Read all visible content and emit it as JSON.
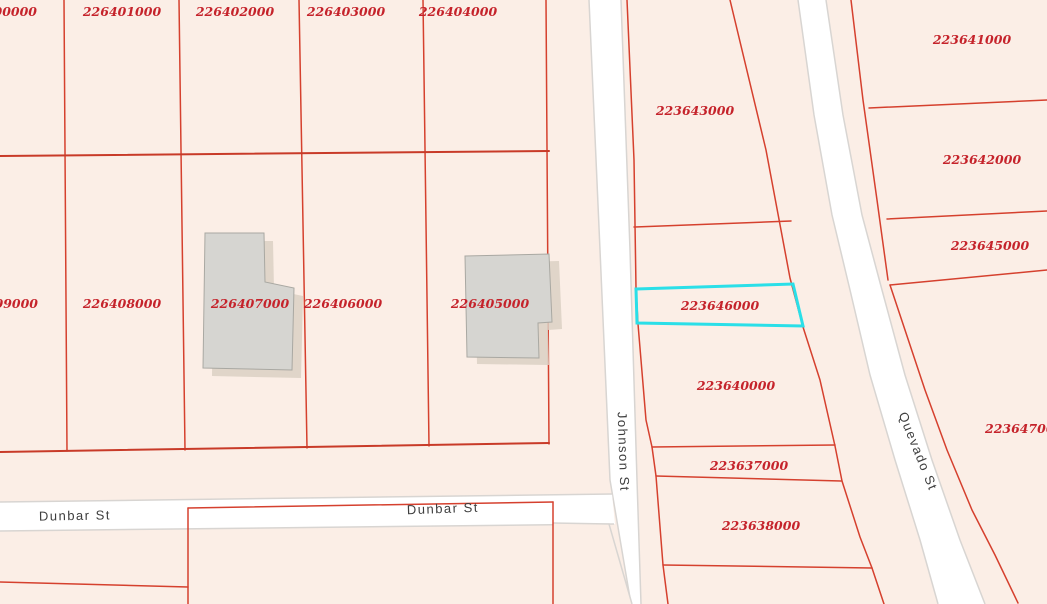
{
  "map_type": "cadastral-parcel-map",
  "highlighted_parcel": "223646000",
  "parcels": [
    {
      "id": "226400000",
      "note": "clipped-left-edge"
    },
    {
      "id": "226401000"
    },
    {
      "id": "226402000"
    },
    {
      "id": "226403000"
    },
    {
      "id": "226404000"
    },
    {
      "id": "226409000",
      "note": "clipped-left-edge"
    },
    {
      "id": "226408000"
    },
    {
      "id": "226407000",
      "has_building": true
    },
    {
      "id": "226406000"
    },
    {
      "id": "226405000",
      "has_building": true
    },
    {
      "id": "223643000"
    },
    {
      "id": "223641000"
    },
    {
      "id": "223642000"
    },
    {
      "id": "223645000"
    },
    {
      "id": "223646000",
      "highlighted": true
    },
    {
      "id": "223640000"
    },
    {
      "id": "223637000"
    },
    {
      "id": "223638000"
    },
    {
      "id": "223647000",
      "note": "clipped-right-edge"
    }
  ],
  "streets": [
    {
      "name": "Johnson St",
      "orientation": "vertical"
    },
    {
      "name": "Quevado St",
      "orientation": "diagonal"
    },
    {
      "name": "Dunbar St",
      "orientation": "horizontal"
    },
    {
      "name": "Dunbar St",
      "orientation": "horizontal"
    }
  ],
  "colors": {
    "background": "#fbeee6",
    "parcel_line": "#d5402e",
    "parcel_label": "#c5232b",
    "highlight": "#2adfe8",
    "road_fill": "#ffffff",
    "road_casing": "#d8d5d2",
    "building_fill": "#d6d5d1",
    "building_shadow": "#dbd0c3",
    "street_label": "#3d3d3d"
  }
}
